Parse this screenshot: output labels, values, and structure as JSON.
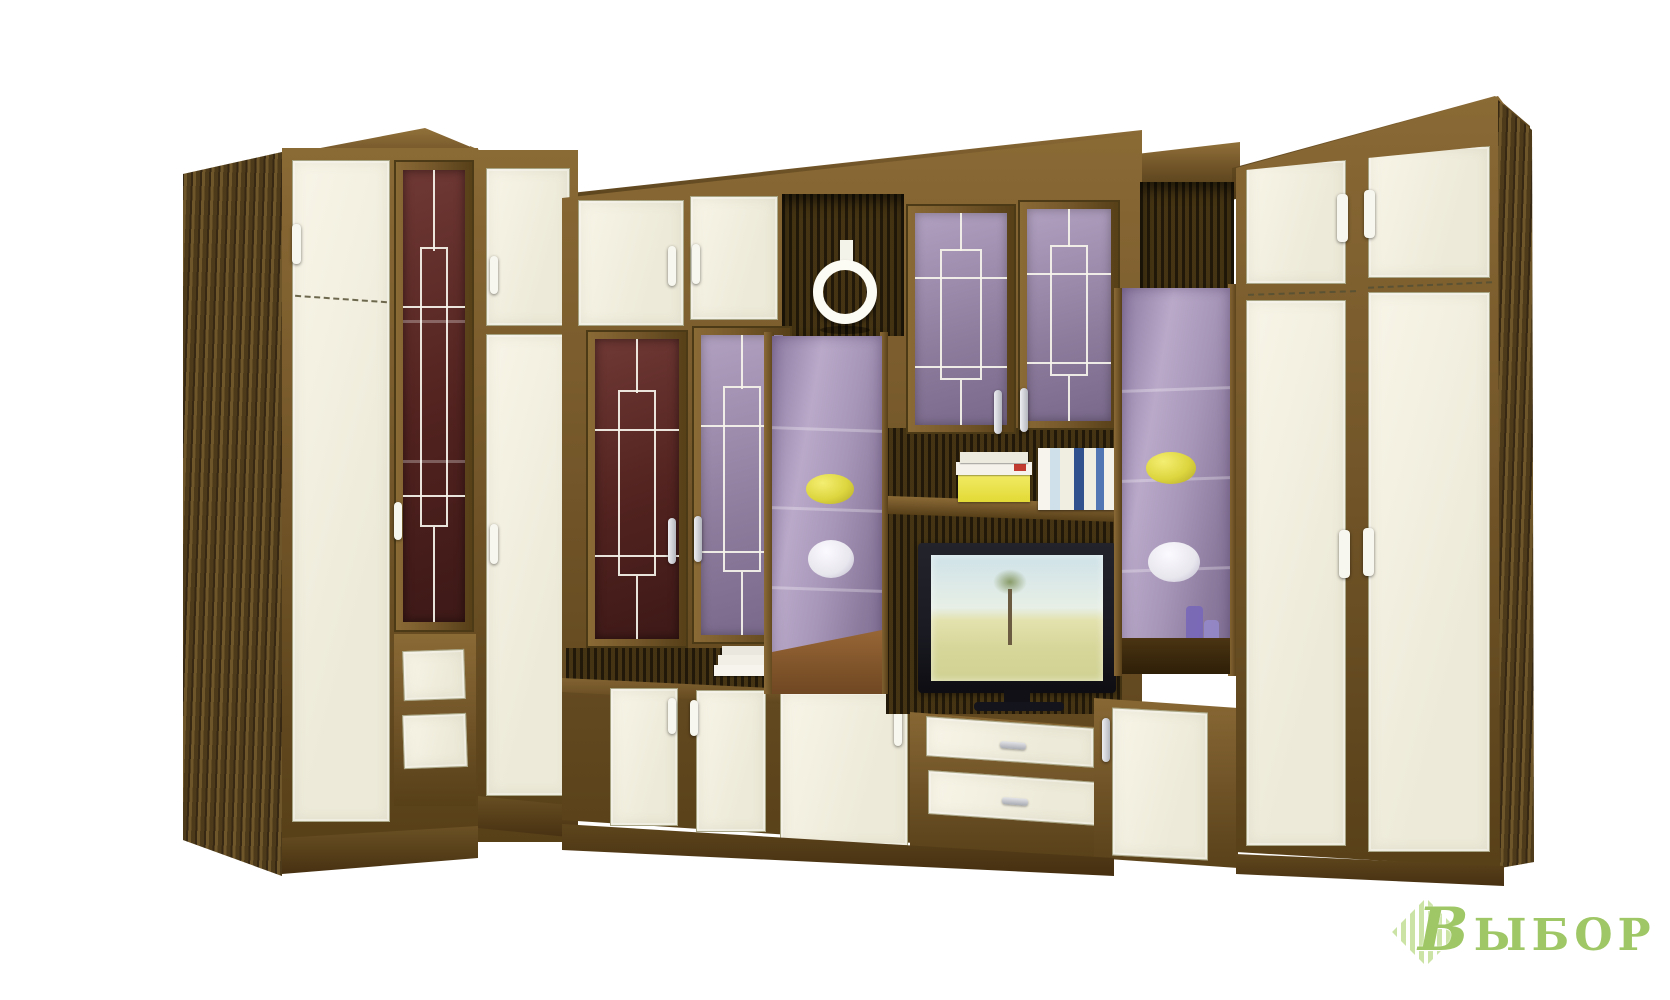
{
  "scene": {
    "type": "furniture-product-photo",
    "subject": "corner living-room wall unit with wardrobes, glass display cabinets, drawers and TV niche",
    "background": "white studio backdrop"
  },
  "watermark": {
    "text": "Выбор",
    "badge": "striped-diamond-logo"
  },
  "palette": {
    "background": "#ffffff",
    "wood_frame": "#74572a",
    "wood_frame_dark": "#573f18",
    "wood_frame_light": "#8a6a35",
    "door_cream": "#f3f0e2",
    "glass_maroon": "#5a2422",
    "glass_purple": "#9d8bac",
    "display_purple": "#a995b8",
    "lattice_white": "#eceadf",
    "handle_white": "#f6f5ec",
    "handle_silver": "#d6d7db",
    "vase_yellow": "#ddd63f",
    "vase_white": "#e9e7ee",
    "tv_frame": "#1a1a22",
    "tv_sky": "#cfe2e8",
    "tv_field": "#d8d79b",
    "watermark_green": "#9fc766"
  },
  "objects": {
    "ring": "decorative-ring-ornament",
    "yellow_vases": "squat yellow vases inside purple display cabinets",
    "white_vases": "round white vases inside purple display cabinets",
    "books_upper_shelf": "stack of books with yellow box and standing books above TV",
    "books_lower_shelf": "small stack of white books on lower shelf",
    "candles": "tall translucent purple candles",
    "tv": "flat-screen TV showing savanna landscape with tree"
  }
}
